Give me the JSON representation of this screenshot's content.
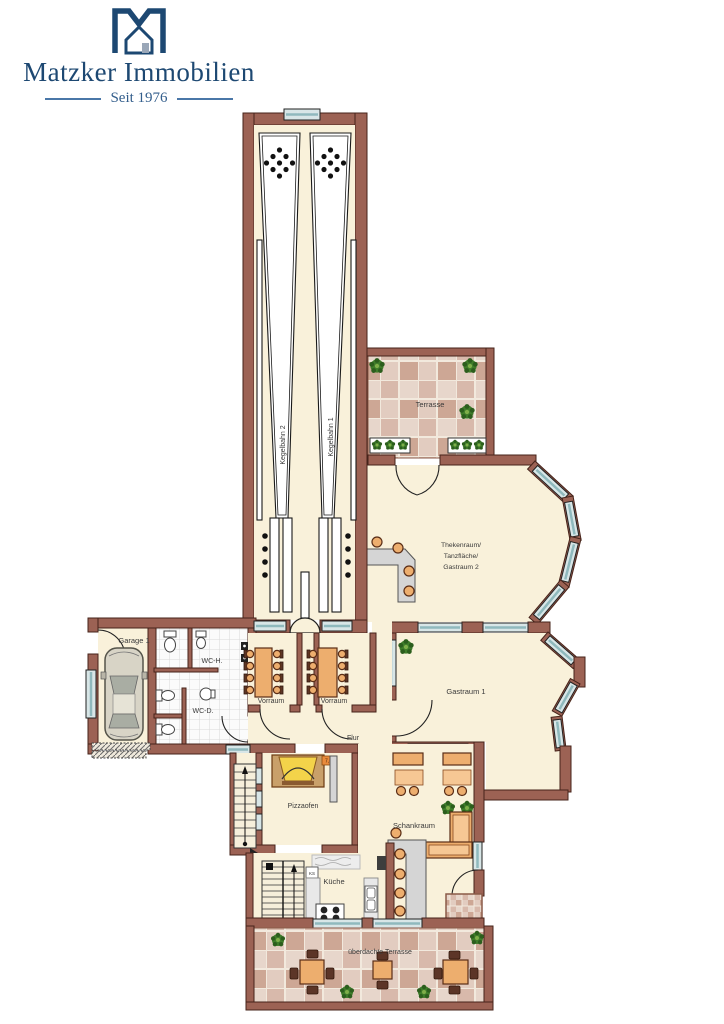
{
  "logo": {
    "company": "Matzker Immobilien",
    "tagline": "Seit 1976"
  },
  "labels": {
    "kegelbahn_1": "Kegelbahn 1",
    "kegelbahn_2": "Kegelbahn 2",
    "terrasse": "Terrasse",
    "thekenraum_lines": [
      "Thekenraum/",
      "Tanzfläche/",
      "Gastraum 2"
    ],
    "garage_1": "Garage 1",
    "wc_h": "WC-H.",
    "wc_d": "WC-D.",
    "vorraum_left": "Vorraum",
    "vorraum_right": "Vorraum",
    "flur": "Flur",
    "gastraum_1": "Gastraum 1",
    "pizzaofen": "Pizzaofen",
    "schankraum": "Schankraum",
    "kueche": "Küche",
    "ueberdachte_terrasse": "überdachte Terrasse",
    "oven_tag": "7,5",
    "ks_tag": "KS"
  },
  "colors": {
    "brand_navy": "#1d4872",
    "wall_brown": "#9c6254",
    "wall_outline": "#46231a",
    "floor_cream": "#f9f1da",
    "window_blue": "#d8e6e7",
    "tile_light": "#e7d6cb",
    "tile_dark": "#cda795",
    "furniture_tan": "#edae6e",
    "counter_gray": "#d5d5d5",
    "plant_green": "#3f7d2a"
  }
}
